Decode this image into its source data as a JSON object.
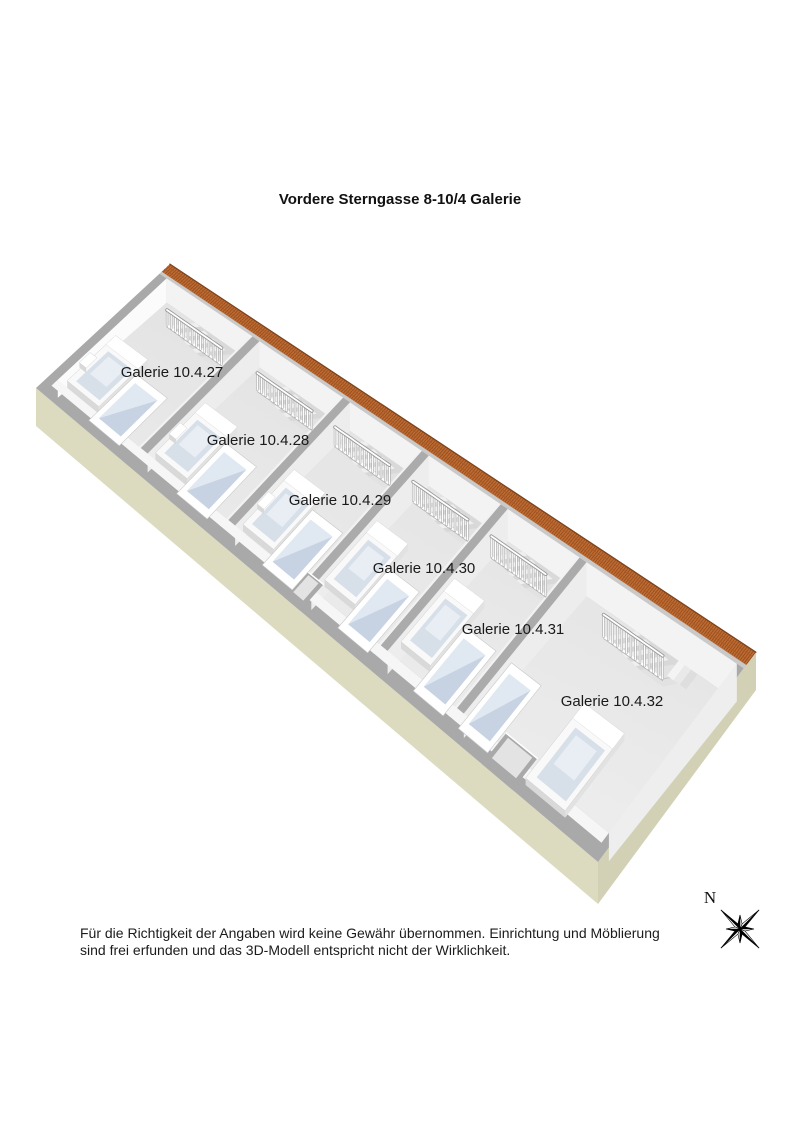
{
  "title": "Vordere Sterngasse 8-10/4 Galerie",
  "disclaimer": {
    "line1": "Für die Richtigkeit der Angaben wird keine Gewähr übernommen. Einrichtung und Möblierung",
    "line2": "sind frei erfunden und das 3D-Modell entspricht nicht der Wirklichkeit."
  },
  "compass": {
    "label": "N"
  },
  "floorplan": {
    "rooms": [
      {
        "label": "Galerie 10.4.27",
        "label_pos": [
          172,
          372
        ],
        "s": [
          0.014,
          0.158
        ],
        "stair": [
          0.062,
          0.156
        ],
        "bed": [
          0.022,
          0.078
        ],
        "bed_t": [
          0.5,
          0.86
        ],
        "panel": [
          0.082,
          0.136
        ],
        "nightstand": true
      },
      {
        "label": "Galerie 10.4.28",
        "label_pos": [
          258,
          440
        ],
        "s": [
          0.172,
          0.313
        ],
        "stair": [
          0.218,
          0.312
        ],
        "bed": [
          0.178,
          0.234
        ],
        "bed_t": [
          0.5,
          0.86
        ],
        "panel": [
          0.238,
          0.292
        ],
        "nightstand": true
      },
      {
        "label": "Galerie 10.4.29",
        "label_pos": [
          340,
          500
        ],
        "s": [
          0.327,
          0.448
        ],
        "stair": [
          0.352,
          0.446
        ],
        "bed": [
          0.333,
          0.387
        ],
        "bed_t": [
          0.5,
          0.86
        ],
        "panel": [
          0.39,
          0.443
        ],
        "nightstand": true
      },
      {
        "label": "Galerie 10.4.30",
        "label_pos": [
          424,
          568
        ],
        "s": [
          0.462,
          0.583
        ],
        "stair": [
          0.487,
          0.581
        ],
        "bed": [
          0.467,
          0.521
        ],
        "bed_t": [
          0.46,
          0.82
        ],
        "panel": [
          0.524,
          0.577
        ],
        "nightstand": false
      },
      {
        "label": "Galerie 10.4.31",
        "label_pos": [
          513,
          629
        ],
        "s": [
          0.597,
          0.718
        ],
        "stair": [
          0.622,
          0.716
        ],
        "bed": [
          0.602,
          0.654
        ],
        "bed_t": [
          0.46,
          0.82
        ],
        "panel": [
          0.658,
          0.711
        ],
        "nightstand": false
      },
      {
        "label": "Galerie 10.4.32",
        "label_pos": [
          612,
          701
        ],
        "s": [
          0.732,
          0.986
        ],
        "stair": [
          0.816,
          0.918
        ],
        "bed": [
          0.852,
          0.922
        ],
        "bed_t": [
          0.55,
          0.93
        ],
        "panel": [
          0.738,
          0.79
        ],
        "alcove": [
          0.793,
          0.848
        ],
        "nightstand": false
      }
    ],
    "geometry": {
      "corners": {
        "n": [
          170,
          264
        ],
        "e": [
          756,
          652
        ],
        "s": [
          598,
          862
        ],
        "w": [
          36,
          388
        ]
      },
      "dividers": [
        0.165,
        0.32,
        0.455,
        0.59,
        0.725
      ],
      "roof_t": 0.062,
      "face_t": 0.078,
      "floor_t": 0.888,
      "swall_t": 0.935,
      "stair_t": [
        0.078,
        0.29
      ],
      "wall_drop": [
        24,
        14
      ],
      "base_drop": 42
    },
    "colors": {
      "roof": "#bf6a30",
      "roof_line": "#8a4a1f",
      "roof_edge": "#7c431d",
      "roof_row": "#a85a28",
      "wall_top": "#a9a9a9",
      "divider_top": "#ababab",
      "divider_hi": "#f2f2f2",
      "wall_face": "#f3f3f3",
      "wall_face_nw": "#fbfbfb",
      "wall_face_se": "#eeeeee",
      "divider_face": "#ededed",
      "floor_ne": "#e2e2e2",
      "floor_sw": "#ededed",
      "sw_strip": "#f6f6f6",
      "stair_hole": "#d9d9d9",
      "step_light": "#f0f0f0",
      "step_dark": "#d8d8d8",
      "landing": "#e2e2e2",
      "base_sw": "#dcdbc0",
      "base_se": "#d2d1b5",
      "rail_shadow": "#a2a2a2",
      "rail_white": "#ffffff",
      "bed_top": "#f9f9f9",
      "bed_side": "#d9d9d9",
      "bed_side2": "#e2e2e2",
      "mattress": "#d7dfe9",
      "mattress_hi": "#e9eef4",
      "glass": "#c7d3e2",
      "glass_hi": "#e0e8f1",
      "niche": "#e3e3e3",
      "text": "#1a1a1a"
    }
  }
}
